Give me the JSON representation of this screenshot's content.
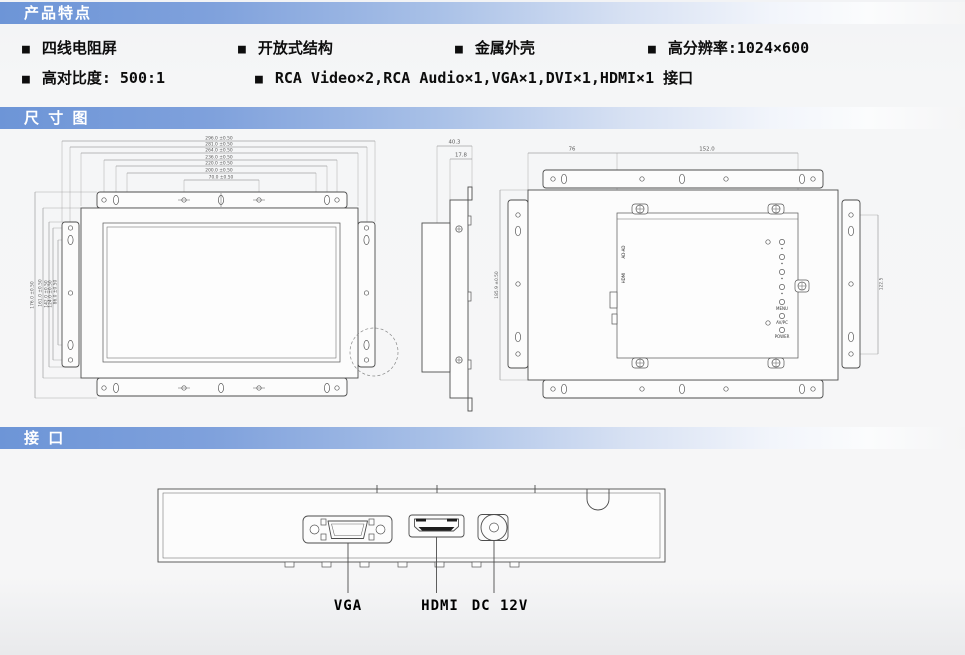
{
  "banners": {
    "features": "产品特点",
    "dimensions": "尺 寸 图",
    "interfaces": "接  口"
  },
  "bullet": "■",
  "features": {
    "row1": [
      "四线电阻屏",
      "开放式结构",
      "金属外壳",
      "高分辨率:1024×600"
    ],
    "row2": [
      "高对比度: 500:1",
      "RCA Video×2,RCA Audio×1,VGA×1,DVI×1,HDMI×1 接口"
    ]
  },
  "dimension_diagram": {
    "front_view": {
      "top_dims": [
        "296.0 ±0.50",
        "281.0 ±0.50",
        "264.0 ±0.50",
        "236.0 ±0.50",
        "220.0 ±0.50",
        "200.0 ±0.50",
        "70.0 ±0.50"
      ],
      "left_dims": [
        "176.0 ±0.50",
        "161.0 ±0.50",
        "142.0 ±0.50",
        "124.0 ±0.50",
        "86.0 ±0.50"
      ]
    },
    "side_view": {
      "depth": "40.3",
      "panel_depth": "17.8"
    },
    "rear_view": {
      "top_dim_left": "76",
      "top_dim_right": "152.0",
      "height_dim": "185.9 ±0.50",
      "bracket_dim": "122.5",
      "board_labels": [
        "AD-AD",
        "HDMI"
      ],
      "button_labels": [
        "MENU",
        "AV/PC",
        "POWER"
      ]
    }
  },
  "interface_diagram": {
    "port_labels": [
      "VGA",
      "HDMI",
      "DC 12V"
    ]
  },
  "colors": {
    "banner_blue": "#6d95d7",
    "line": "#4d4d4d",
    "background": "#f3f4f5"
  }
}
